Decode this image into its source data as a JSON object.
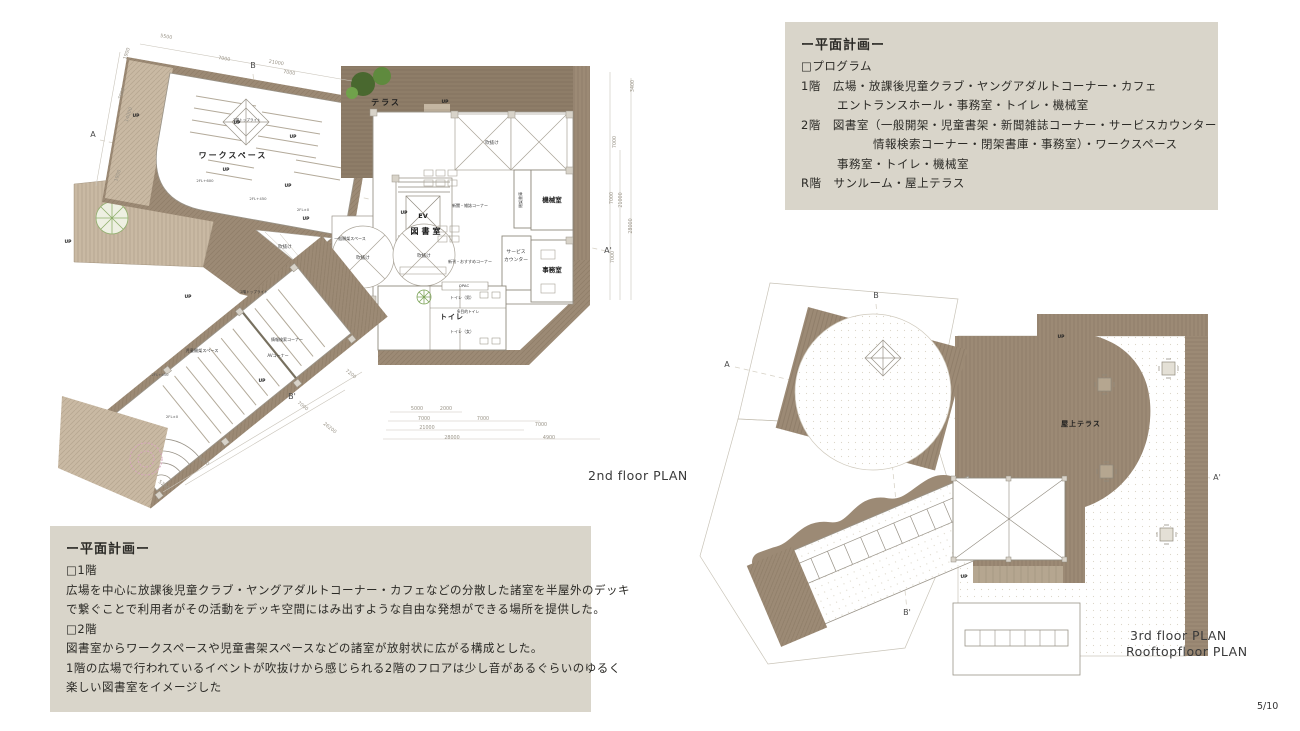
{
  "colors": {
    "deck": "#9c8a75",
    "terrace_deck": "#8e7d68",
    "light_deck": "#c9b9a3",
    "box_bg": "#d9d5ca",
    "plan_line": "#999388",
    "tree_green": "#49682f",
    "tree_pink": "#d5a8bb"
  },
  "program_box": {
    "title": "ー平面計画ー",
    "lines": [
      "□プログラム",
      "1階　広場・放課後児童クラブ・ヤングアダルトコーナー・カフェ",
      "　　　エントランスホール・事務室・トイレ・機械室",
      "2階　図書室（一般開架・児童書架・新聞雑誌コーナー・サービスカウンター",
      "　　　　　　情報検索コーナー・閉架書庫・事務室）・ワークスペース",
      "　　　事務室・トイレ・機械室",
      "R階　サンルーム・屋上テラス"
    ]
  },
  "description_box": {
    "title": "ー平面計画ー",
    "lines": [
      "□1階",
      "広場を中心に放課後児童クラブ・ヤングアダルトコーナー・カフェなどの分散した諸室を半屋外のデッキ",
      "で繋ぐことで利用者がその活動をデッキ空間にはみ出すような自由な発想ができる場所を提供した。",
      "□2階",
      "図書室からワークスペースや児童書架スペースなどの諸室が放射状に広がる構成とした。",
      "1階の広場で行われているイベントが吹抜けから感じられる2階のフロアは少し音があるぐらいのゆるく",
      "楽しい図書室をイメージした"
    ]
  },
  "captions": {
    "plan2f": "2nd floor  PLAN",
    "plan3f1": "3rd floor  PLAN",
    "plan3f2": "Rooftopfloor PLAN",
    "page": "5/10"
  },
  "plan2f": {
    "labels": [
      {
        "t": "ワークスペース",
        "x": 233,
        "y": 158,
        "s": 8,
        "k": "room",
        "ls": 2
      },
      {
        "t": "テラス",
        "x": 386,
        "y": 105,
        "s": 8,
        "k": "room",
        "ls": 2
      },
      {
        "t": "図書室",
        "x": 427,
        "y": 234,
        "s": 8,
        "k": "room",
        "ls": 3
      },
      {
        "t": "EV",
        "x": 423,
        "y": 218,
        "s": 6.5,
        "k": "room"
      },
      {
        "t": "機械室",
        "x": 552,
        "y": 202,
        "s": 6.5,
        "k": "room"
      },
      {
        "t": "事務室",
        "x": 552,
        "y": 272,
        "s": 6.5,
        "k": "room"
      },
      {
        "t": "トイレ",
        "x": 452,
        "y": 319,
        "s": 7,
        "k": "room",
        "ls": 1
      },
      {
        "t": "吹抜け",
        "x": 492,
        "y": 144,
        "s": 4.5
      },
      {
        "t": "吹抜け",
        "x": 363,
        "y": 259,
        "s": 4.5
      },
      {
        "t": "吹抜け",
        "x": 424,
        "y": 257,
        "s": 4.5
      },
      {
        "t": "吹抜け",
        "x": 285,
        "y": 248,
        "s": 4.5
      },
      {
        "t": "一般開架スペース",
        "x": 350,
        "y": 240,
        "s": 4
      },
      {
        "t": "新聞・雑誌コーナー",
        "x": 470,
        "y": 207,
        "s": 4
      },
      {
        "t": "新刊・おすすめコーナー",
        "x": 470,
        "y": 263,
        "s": 4
      },
      {
        "t": "サービス",
        "x": 516,
        "y": 253,
        "s": 4.8
      },
      {
        "t": "カウンター",
        "x": 516,
        "y": 261,
        "s": 4.8
      },
      {
        "t": "閉架書庫",
        "x": 522,
        "y": 200,
        "s": 4,
        "r": -90
      },
      {
        "t": "OPAC",
        "x": 464,
        "y": 287,
        "s": 3.8
      },
      {
        "t": "トイレ（男）",
        "x": 462,
        "y": 299,
        "s": 4
      },
      {
        "t": "多目的トイレ",
        "x": 468,
        "y": 313,
        "s": 3.8
      },
      {
        "t": "トイレ（女）",
        "x": 462,
        "y": 333,
        "s": 4
      },
      {
        "t": "児童開架スペース",
        "x": 202,
        "y": 352,
        "s": 4.2
      },
      {
        "t": "情報検索コーナー",
        "x": 287,
        "y": 341,
        "s": 4
      },
      {
        "t": "AVコーナー",
        "x": 278,
        "y": 357,
        "s": 4
      },
      {
        "t": "2階トップライト",
        "x": 247,
        "y": 121,
        "s": 3.6
      },
      {
        "t": "2階トップライト",
        "x": 254,
        "y": 293,
        "s": 3.6
      },
      {
        "t": "2FL+600",
        "x": 205,
        "y": 182,
        "s": 3.8,
        "k": "level"
      },
      {
        "t": "2FL+450",
        "x": 258,
        "y": 200,
        "s": 3.8,
        "k": "level"
      },
      {
        "t": "2FL±0",
        "x": 303,
        "y": 211,
        "s": 3.8,
        "k": "level"
      },
      {
        "t": "2FL+450",
        "x": 160,
        "y": 376,
        "s": 3.8,
        "k": "level"
      },
      {
        "t": "2FL±0",
        "x": 172,
        "y": 418,
        "s": 3.8,
        "k": "level"
      },
      {
        "t": "UP",
        "x": 136,
        "y": 117,
        "s": 4.5,
        "k": "up"
      },
      {
        "t": "UP",
        "x": 237,
        "y": 124,
        "s": 4.5,
        "k": "up"
      },
      {
        "t": "UP",
        "x": 226,
        "y": 171,
        "s": 4.5,
        "k": "up"
      },
      {
        "t": "UP",
        "x": 293,
        "y": 138,
        "s": 4.5,
        "k": "up"
      },
      {
        "t": "UP",
        "x": 288,
        "y": 187,
        "s": 4.5,
        "k": "up"
      },
      {
        "t": "UP",
        "x": 306,
        "y": 220,
        "s": 4.5,
        "k": "up"
      },
      {
        "t": "UP",
        "x": 404,
        "y": 214,
        "s": 4.5,
        "k": "up"
      },
      {
        "t": "UP",
        "x": 188,
        "y": 298,
        "s": 4.5,
        "k": "up"
      },
      {
        "t": "UP",
        "x": 68,
        "y": 243,
        "s": 4.5,
        "k": "up"
      },
      {
        "t": "UP",
        "x": 262,
        "y": 382,
        "s": 4.5,
        "k": "up"
      },
      {
        "t": "UP",
        "x": 445,
        "y": 103,
        "s": 4.5,
        "k": "up"
      },
      {
        "t": "A",
        "x": 93,
        "y": 137,
        "s": 8,
        "k": "marker"
      },
      {
        "t": "B",
        "x": 253,
        "y": 68,
        "s": 8,
        "k": "marker"
      },
      {
        "t": "A'",
        "x": 608,
        "y": 253,
        "s": 8,
        "k": "marker"
      },
      {
        "t": "B'",
        "x": 292,
        "y": 399,
        "s": 8,
        "k": "marker"
      },
      {
        "t": "5500",
        "x": 166,
        "y": 38,
        "s": 4.8,
        "k": "dim",
        "r": 10
      },
      {
        "t": "7000",
        "x": 224,
        "y": 60,
        "s": 4.8,
        "k": "dim",
        "r": 10
      },
      {
        "t": "21000",
        "x": 276,
        "y": 64,
        "s": 4.8,
        "k": "dim",
        "r": 10
      },
      {
        "t": "7000",
        "x": 289,
        "y": 74,
        "s": 4.8,
        "k": "dim",
        "r": 10
      },
      {
        "t": "1900",
        "x": 128,
        "y": 54,
        "s": 4.8,
        "k": "dim",
        "r": -72
      },
      {
        "t": "7000",
        "x": 123,
        "y": 94,
        "s": 4.8,
        "k": "dim",
        "r": -72
      },
      {
        "t": "14000",
        "x": 130,
        "y": 115,
        "s": 4.8,
        "k": "dim",
        "r": -72
      },
      {
        "t": "1900",
        "x": 119,
        "y": 176,
        "s": 4.8,
        "k": "dim",
        "r": -72
      },
      {
        "t": "3400",
        "x": 634,
        "y": 86,
        "s": 4.8,
        "k": "dim",
        "r": -90
      },
      {
        "t": "7000",
        "x": 616,
        "y": 142,
        "s": 4.8,
        "k": "dim",
        "r": -90
      },
      {
        "t": "7000",
        "x": 613,
        "y": 198,
        "s": 4.8,
        "k": "dim",
        "r": -90
      },
      {
        "t": "21000",
        "x": 622,
        "y": 200,
        "s": 4.8,
        "k": "dim",
        "r": -90
      },
      {
        "t": "28000",
        "x": 632,
        "y": 226,
        "s": 4.8,
        "k": "dim",
        "r": -90
      },
      {
        "t": "7000",
        "x": 614,
        "y": 257,
        "s": 4.8,
        "k": "dim",
        "r": -90
      },
      {
        "t": "5000",
        "x": 417,
        "y": 410,
        "s": 4.8,
        "k": "dim"
      },
      {
        "t": "2000",
        "x": 446,
        "y": 410,
        "s": 4.8,
        "k": "dim"
      },
      {
        "t": "7000",
        "x": 424,
        "y": 420,
        "s": 4.8,
        "k": "dim"
      },
      {
        "t": "7000",
        "x": 483,
        "y": 420,
        "s": 4.8,
        "k": "dim"
      },
      {
        "t": "21000",
        "x": 427,
        "y": 429,
        "s": 4.8,
        "k": "dim"
      },
      {
        "t": "28000",
        "x": 452,
        "y": 439,
        "s": 4.8,
        "k": "dim"
      },
      {
        "t": "7000",
        "x": 541,
        "y": 426,
        "s": 4.8,
        "k": "dim"
      },
      {
        "t": "4900",
        "x": 549,
        "y": 439,
        "s": 4.8,
        "k": "dim"
      },
      {
        "t": "7200",
        "x": 350,
        "y": 375,
        "s": 4.8,
        "k": "dim",
        "r": 38
      },
      {
        "t": "7000",
        "x": 302,
        "y": 407,
        "s": 4.8,
        "k": "dim",
        "r": 38
      },
      {
        "t": "26200",
        "x": 329,
        "y": 429,
        "s": 4.8,
        "k": "dim",
        "r": 38
      },
      {
        "t": "5000",
        "x": 203,
        "y": 462,
        "s": 4.8,
        "k": "dim",
        "r": 38
      },
      {
        "t": "5200",
        "x": 163,
        "y": 486,
        "s": 4.8,
        "k": "dim",
        "r": 38
      }
    ]
  },
  "plan3f": {
    "labels": [
      {
        "t": "屋上テラス",
        "x": 1081,
        "y": 426,
        "s": 7,
        "k": "room",
        "ls": 1
      },
      {
        "t": "A",
        "x": 727,
        "y": 367,
        "s": 8,
        "k": "marker"
      },
      {
        "t": "B",
        "x": 876,
        "y": 298,
        "s": 8,
        "k": "marker"
      },
      {
        "t": "A'",
        "x": 1217,
        "y": 480,
        "s": 8,
        "k": "marker"
      },
      {
        "t": "B'",
        "x": 907,
        "y": 615,
        "s": 8,
        "k": "marker"
      },
      {
        "t": "UP",
        "x": 1061,
        "y": 338,
        "s": 4.5,
        "k": "up"
      },
      {
        "t": "UP",
        "x": 964,
        "y": 578,
        "s": 4.5,
        "k": "up"
      }
    ]
  }
}
